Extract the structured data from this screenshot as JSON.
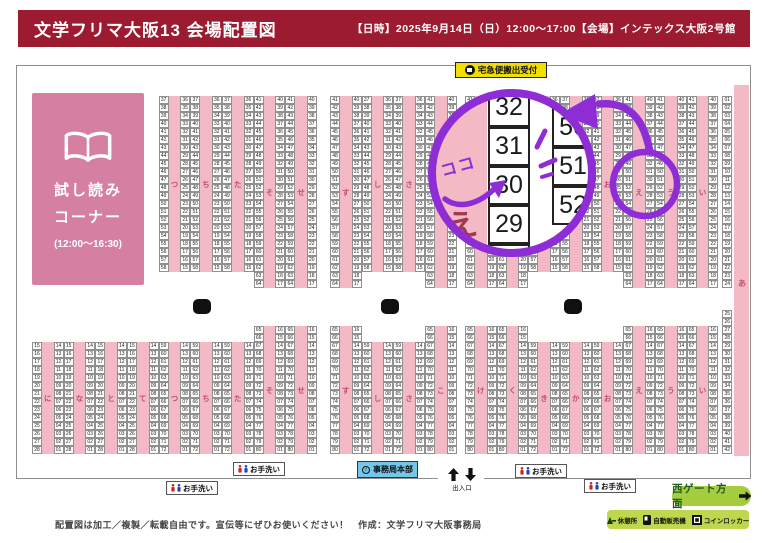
{
  "header": {
    "title": "文学フリマ大阪13 会場配置図",
    "info": "【日時】2025年9月14日（日）12:00～17:00【会場】インテックス大阪2号館"
  },
  "reading_corner": {
    "line1": "試し読み",
    "line2": "コーナー",
    "hours": "(12:00～16:30)"
  },
  "takkyubin_label": "宅急便搬出受付",
  "colors": {
    "header_bg": "#9c1b30",
    "aisle_pink": "#f3b9c5",
    "corner_pink": "#d57fa2",
    "label_red": "#c2506e",
    "annotation_purple": "#8e2cd6",
    "yellow": "#f2de00",
    "office_blue": "#74c7e8",
    "green": "#a5cc3c"
  },
  "map": {
    "top_columns": [
      {
        "label": "つ",
        "x": 158.7,
        "y": 96,
        "left": [
          37,
          58
        ],
        "right": [
          36,
          15
        ]
      },
      {
        "label": "ち",
        "x": 190.3,
        "y": 96,
        "left": [
          37,
          58
        ],
        "right": [
          36,
          15
        ]
      },
      {
        "label": "た",
        "x": 222.0,
        "y": 96,
        "left": [
          37,
          58
        ],
        "right": [
          36,
          15
        ]
      },
      {
        "label": "そ",
        "x": 253.7,
        "y": 96,
        "left": [
          41,
          64
        ],
        "right": [
          40,
          17
        ]
      },
      {
        "label": "せ",
        "x": 285.3,
        "y": 96,
        "left": [
          41,
          64
        ],
        "right": [
          40,
          17
        ]
      },
      {
        "label": "す",
        "x": 330.0,
        "y": 96,
        "left": [
          41,
          64
        ],
        "right": [
          40,
          17
        ]
      },
      {
        "label": "し",
        "x": 361.7,
        "y": 96,
        "left": [
          37,
          58
        ],
        "right": [
          36,
          15
        ]
      },
      {
        "label": "さ",
        "x": 393.3,
        "y": 96,
        "left": [
          37,
          58
        ],
        "right": [
          36,
          15
        ]
      },
      {
        "label": "こ",
        "x": 425.0,
        "y": 96,
        "left": [
          41,
          64
        ],
        "right": [
          40,
          17
        ]
      },
      {
        "label": "け",
        "x": 465.0,
        "y": 96,
        "left": [
          41,
          64
        ],
        "right": [
          40,
          17
        ]
      },
      {
        "label": "く",
        "x": 496.7,
        "y": 96,
        "left": [
          41,
          64
        ],
        "right": [
          40,
          17
        ]
      },
      {
        "label": "き",
        "x": 528.3,
        "y": 96,
        "left": [
          37,
          58
        ],
        "right": [
          36,
          15
        ]
      },
      {
        "label": "か",
        "x": 560.0,
        "y": 96,
        "left": [
          37,
          58
        ],
        "right": [
          36,
          15
        ]
      },
      {
        "label": "お",
        "x": 591.7,
        "y": 96,
        "left": [
          37,
          58
        ],
        "right": [
          36,
          15
        ]
      },
      {
        "label": "え",
        "x": 623.3,
        "y": 96,
        "left": [
          41,
          64
        ],
        "right": [
          40,
          17
        ]
      },
      {
        "label": "う",
        "x": 655.0,
        "y": 96,
        "left": [
          41,
          64
        ],
        "right": [
          40,
          17
        ]
      },
      {
        "label": "い",
        "x": 686.7,
        "y": 96,
        "left": [
          41,
          64
        ],
        "right": [
          40,
          17
        ]
      }
    ],
    "bottom_columns": [
      {
        "label": "に",
        "x": 32.0,
        "y": 342,
        "left": [
          15,
          28
        ],
        "right": [
          14,
          1
        ]
      },
      {
        "label": "な",
        "x": 63.7,
        "y": 342,
        "left": [
          15,
          28
        ],
        "right": [
          14,
          1
        ]
      },
      {
        "label": "と",
        "x": 95.3,
        "y": 342,
        "left": [
          15,
          28
        ],
        "right": [
          14,
          1
        ]
      },
      {
        "label": "て",
        "x": 127.0,
        "y": 342,
        "left": [
          15,
          28
        ],
        "right": [
          14,
          1
        ]
      },
      {
        "label": "つ",
        "x": 158.7,
        "y": 342,
        "left": [
          59,
          72
        ],
        "right": [
          14,
          1
        ]
      },
      {
        "label": "ち",
        "x": 190.3,
        "y": 342,
        "left": [
          59,
          72
        ],
        "right": [
          14,
          1
        ]
      },
      {
        "label": "た",
        "x": 222.0,
        "y": 342,
        "left": [
          59,
          72
        ],
        "right": [
          14,
          1
        ]
      },
      {
        "label": "そ",
        "x": 253.7,
        "y": 326,
        "left": [
          65,
          80
        ],
        "right": [
          16,
          1
        ]
      },
      {
        "label": "せ",
        "x": 285.3,
        "y": 326,
        "left": [
          65,
          80
        ],
        "right": [
          16,
          1
        ]
      },
      {
        "label": "す",
        "x": 330.0,
        "y": 326,
        "left": [
          65,
          80
        ],
        "right": [
          16,
          1
        ]
      },
      {
        "label": "し",
        "x": 361.7,
        "y": 342,
        "left": [
          59,
          72
        ],
        "right": [
          14,
          1
        ]
      },
      {
        "label": "さ",
        "x": 393.3,
        "y": 342,
        "left": [
          59,
          72
        ],
        "right": [
          14,
          1
        ]
      },
      {
        "label": "こ",
        "x": 425.0,
        "y": 326,
        "left": [
          65,
          80
        ],
        "right": [
          16,
          1
        ]
      },
      {
        "label": "け",
        "x": 465.0,
        "y": 326,
        "left": [
          65,
          80
        ],
        "right": [
          16,
          1
        ]
      },
      {
        "label": "く",
        "x": 496.7,
        "y": 326,
        "left": [
          65,
          80
        ],
        "right": [
          16,
          1
        ]
      },
      {
        "label": "き",
        "x": 528.3,
        "y": 342,
        "left": [
          59,
          72
        ],
        "right": [
          14,
          1
        ]
      },
      {
        "label": "か",
        "x": 560.0,
        "y": 342,
        "left": [
          59,
          72
        ],
        "right": [
          14,
          1
        ]
      },
      {
        "label": "お",
        "x": 591.7,
        "y": 342,
        "left": [
          59,
          72
        ],
        "right": [
          14,
          1
        ]
      },
      {
        "label": "え",
        "x": 623.3,
        "y": 326,
        "left": [
          65,
          80
        ],
        "right": [
          16,
          1
        ]
      },
      {
        "label": "う",
        "x": 655.0,
        "y": 326,
        "left": [
          65,
          80
        ],
        "right": [
          16,
          1
        ]
      },
      {
        "label": "い",
        "x": 686.7,
        "y": 326,
        "left": [
          65,
          80
        ],
        "right": [
          16,
          1
        ]
      }
    ],
    "a_column": {
      "label": "あ",
      "x": 722.3,
      "segments": [
        {
          "y": 96,
          "from": 1,
          "to": 24
        },
        {
          "y": 310,
          "from": 25,
          "to": 42
        }
      ],
      "aisle": {
        "x": 734,
        "y": 85,
        "w": 15,
        "h": 371,
        "label_y": 193
      }
    },
    "pillars": [
      {
        "x": 193,
        "y": 299
      },
      {
        "x": 381,
        "y": 299
      },
      {
        "x": 564,
        "y": 299
      }
    ]
  },
  "annotations": {
    "koko": "ココ",
    "magnifier_left_cells": [
      "32",
      "31",
      "30",
      "29",
      "28"
    ],
    "magnifier_right_cells": [
      "50",
      "51",
      "52"
    ],
    "magnifier_aisle_label": "え"
  },
  "facilities": {
    "restroom_label": "お手洗い",
    "restrooms": [
      {
        "x": 233,
        "y": 462
      },
      {
        "x": 166,
        "y": 481
      },
      {
        "x": 515,
        "y": 464
      },
      {
        "x": 584,
        "y": 479
      }
    ],
    "office_label": "事務局本部",
    "office_icon": "i",
    "exit_label": "出入口",
    "west_gate_label": "西ゲート方面",
    "legend_items": [
      "休憩所",
      "自動販売機",
      "コインロッカー"
    ]
  },
  "footer": {
    "note": "配置図は加工／複製／転載自由です。宣伝等にぜひお使いください！　作成：文学フリマ大阪事務局"
  }
}
